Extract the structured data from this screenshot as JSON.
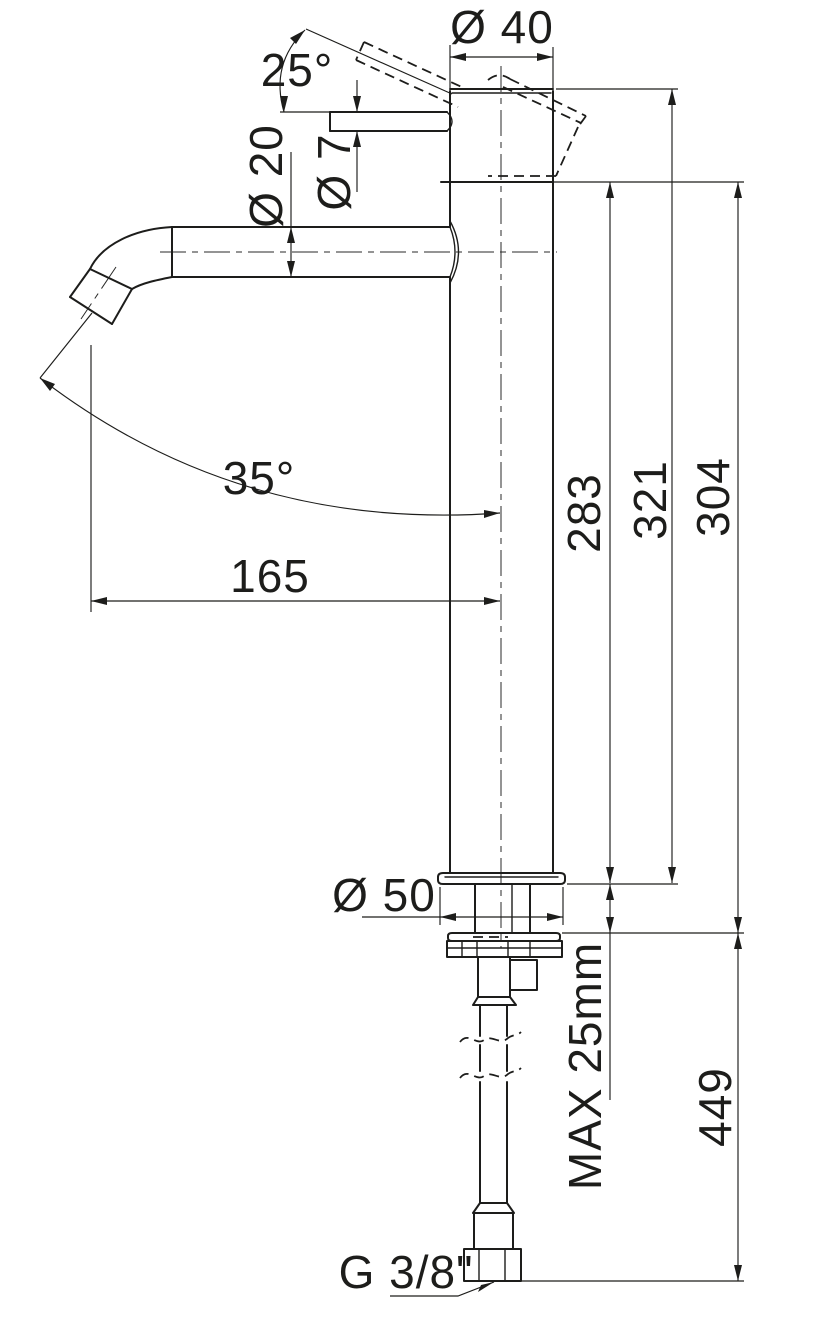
{
  "drawing": {
    "title": "Single-lever tall basin mixer — dimensional drawing",
    "line_color": "#1d1d1b",
    "background_color": "#ffffff",
    "labels": {
      "dia_cartridge_top": "Ø 40",
      "handle_angle": "25°",
      "dia_spout_tube": "Ø 20",
      "dia_lever_rod": "Ø 7",
      "spout_outlet_angle": "35°",
      "spout_reach": "165",
      "height_spout_section": "283",
      "height_overall": "321",
      "height_body": "304",
      "dia_base_flange": "Ø 50",
      "deck_thickness": "MAX 25mm",
      "length_below_deck": "449",
      "supply_thread": "G 3/8\""
    },
    "dimensions": [
      {
        "name": "cartridge-top-diameter",
        "value": 40,
        "unit": "mm",
        "type": "diameter",
        "text": "Ø 40"
      },
      {
        "name": "handle-opening-angle",
        "value": 25,
        "unit": "deg",
        "type": "angle",
        "text": "25°"
      },
      {
        "name": "spout-tube-diameter",
        "value": 20,
        "unit": "mm",
        "type": "diameter",
        "text": "Ø 20"
      },
      {
        "name": "lever-rod-diameter",
        "value": 7,
        "unit": "mm",
        "type": "diameter",
        "text": "Ø 7"
      },
      {
        "name": "outlet-stream-angle",
        "value": 35,
        "unit": "deg",
        "type": "angle",
        "text": "35°"
      },
      {
        "name": "spout-reach",
        "value": 165,
        "unit": "mm",
        "type": "linear",
        "text": "165"
      },
      {
        "name": "spout-section-height",
        "value": 283,
        "unit": "mm",
        "type": "linear",
        "text": "283"
      },
      {
        "name": "overall-height",
        "value": 321,
        "unit": "mm",
        "type": "linear",
        "text": "321"
      },
      {
        "name": "body-height-above-deck",
        "value": 304,
        "unit": "mm",
        "type": "linear",
        "text": "304"
      },
      {
        "name": "base-flange-diameter",
        "value": 50,
        "unit": "mm",
        "type": "diameter",
        "text": "Ø 50"
      },
      {
        "name": "max-deck-thickness",
        "value": 25,
        "unit": "mm",
        "type": "limit",
        "text": "MAX 25mm"
      },
      {
        "name": "length-below-deck",
        "value": 449,
        "unit": "mm",
        "type": "linear",
        "text": "449"
      },
      {
        "name": "supply-hose-thread",
        "value": "3/8",
        "unit": "inch",
        "type": "thread",
        "text": "G 3/8\""
      }
    ]
  }
}
